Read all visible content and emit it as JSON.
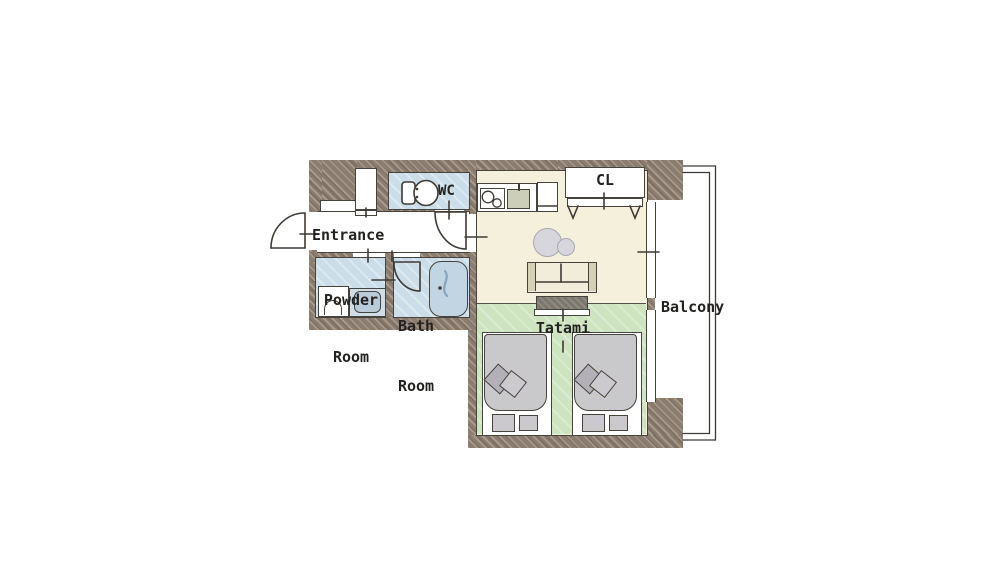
{
  "title": "apartment-floor-plan",
  "labels": {
    "entrance": "Entrance",
    "powder_room_line1": "Powder",
    "powder_room_line2": "Room",
    "bath_room_line1": "Bath",
    "bath_room_line2": "Room",
    "wc": "WC",
    "closet": "CL",
    "tatami": "Tatami",
    "balcony": "Balcony"
  },
  "colors": {
    "wall": "#8c7d71",
    "wet_room": "#cbdde8",
    "closet_fill": "#fae4c1",
    "living_floor": "#f4f0dc",
    "tatami_floor": "#cee4c1",
    "bed_duvet": "#c9c8cb",
    "bathtub_fill": "#c2d5e2",
    "tv_board": "#7b776c",
    "outline": "#46423c",
    "label_text": "#232220"
  },
  "furniture_icons": [
    "entrance-door-icon",
    "toilet-icon",
    "bathtub-icon",
    "washing-machine-icon",
    "vanity-sink-icon",
    "shoe-cabinet-icon",
    "stove-icon",
    "kitchen-sink-icon",
    "refrigerator-icon",
    "closet-folding-door-icon",
    "sofa-icon",
    "tv-board-icon",
    "floor-cushion-icon",
    "bed-icon",
    "window-icon",
    "balcony-railing-icon"
  ]
}
